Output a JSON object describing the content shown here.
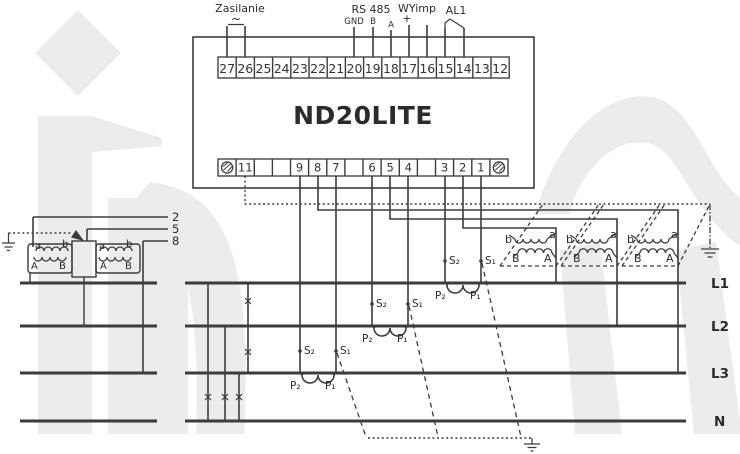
{
  "device": {
    "name": "ND20LITE",
    "top_terminals": [
      "27",
      "26",
      "25",
      "24",
      "23",
      "22",
      "21",
      "20",
      "19",
      "18",
      "17",
      "16",
      "15",
      "14",
      "13",
      "12"
    ],
    "bottom_terminals": [
      "11",
      "9",
      "8",
      "7",
      "6",
      "5",
      "4",
      "3",
      "2",
      "1"
    ]
  },
  "top_labels": {
    "power": "Zasilanie",
    "power_symbol": "~",
    "rs485": "RS 485",
    "rs485_gnd": "GND",
    "rs485_b": "B",
    "rs485_a": "A",
    "pulse_output": "WYimp",
    "pulse_plus": "+",
    "alarm": "AL1"
  },
  "bus_labels": {
    "l1": "L1",
    "l2": "L2",
    "l3": "L3",
    "n": "N"
  },
  "voltage_tap_labels": {
    "u1": "2",
    "u2": "5",
    "u3": "8"
  },
  "ct_labels": {
    "s2": "S₂",
    "s1": "S₁",
    "p2": "P₂",
    "p1": "P₁"
  },
  "vt_labels": {
    "sec_a": "a",
    "sec_b": "b",
    "pri_a": "A",
    "pri_b": "B"
  },
  "colors": {
    "line": "#3c3c3c",
    "text": "#2b2b2b",
    "watermark": "#ececec",
    "background": "#ffffff"
  }
}
